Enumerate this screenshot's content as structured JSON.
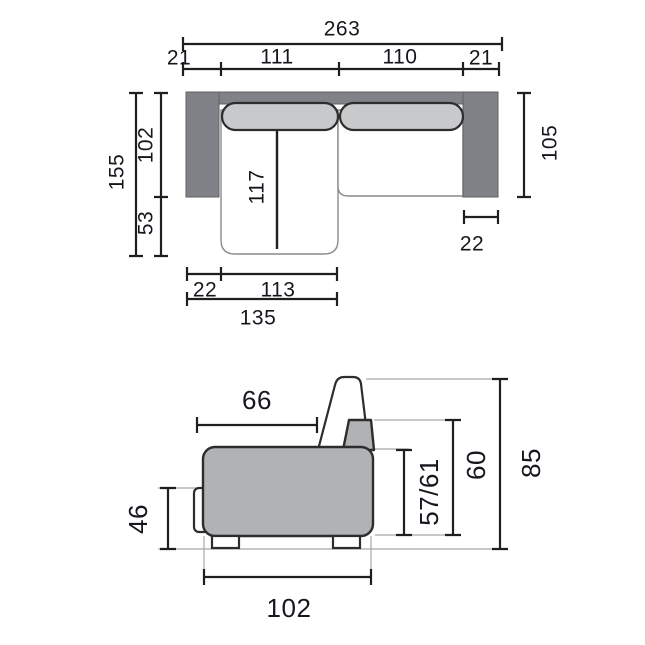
{
  "diagram_title": "sofa-bed dimension drawing",
  "top_view": {
    "dims": {
      "overall_width": "263",
      "arm_left_width": "21",
      "seat_left_width": "111",
      "seat_right_width": "110",
      "arm_right_width": "21",
      "overall_depth": "155",
      "sofa_depth": "102",
      "chaise_extension": "53",
      "chaise_length": "117",
      "right_side_depth": "105",
      "arm_width": "22",
      "chaise_inset": "22",
      "chaise_width": "113",
      "chaise_overall_width": "135"
    }
  },
  "side_view": {
    "dims": {
      "seat_depth": "66",
      "base_height": "46",
      "seat_height": "57/61",
      "armrest_height": "60",
      "overall_height": "85",
      "overall_depth": "102"
    }
  },
  "colors": {
    "frame_dark": "#818287",
    "frame_edge": "#5f6064",
    "cushion_light": "#c8c9cb",
    "body_gray": "#b1b2b4",
    "outline": "#2d2d2d",
    "seat_edge": "#8a8a8a",
    "dim_line": "#1f1f1f",
    "ref_line": "#a8a8a8"
  }
}
